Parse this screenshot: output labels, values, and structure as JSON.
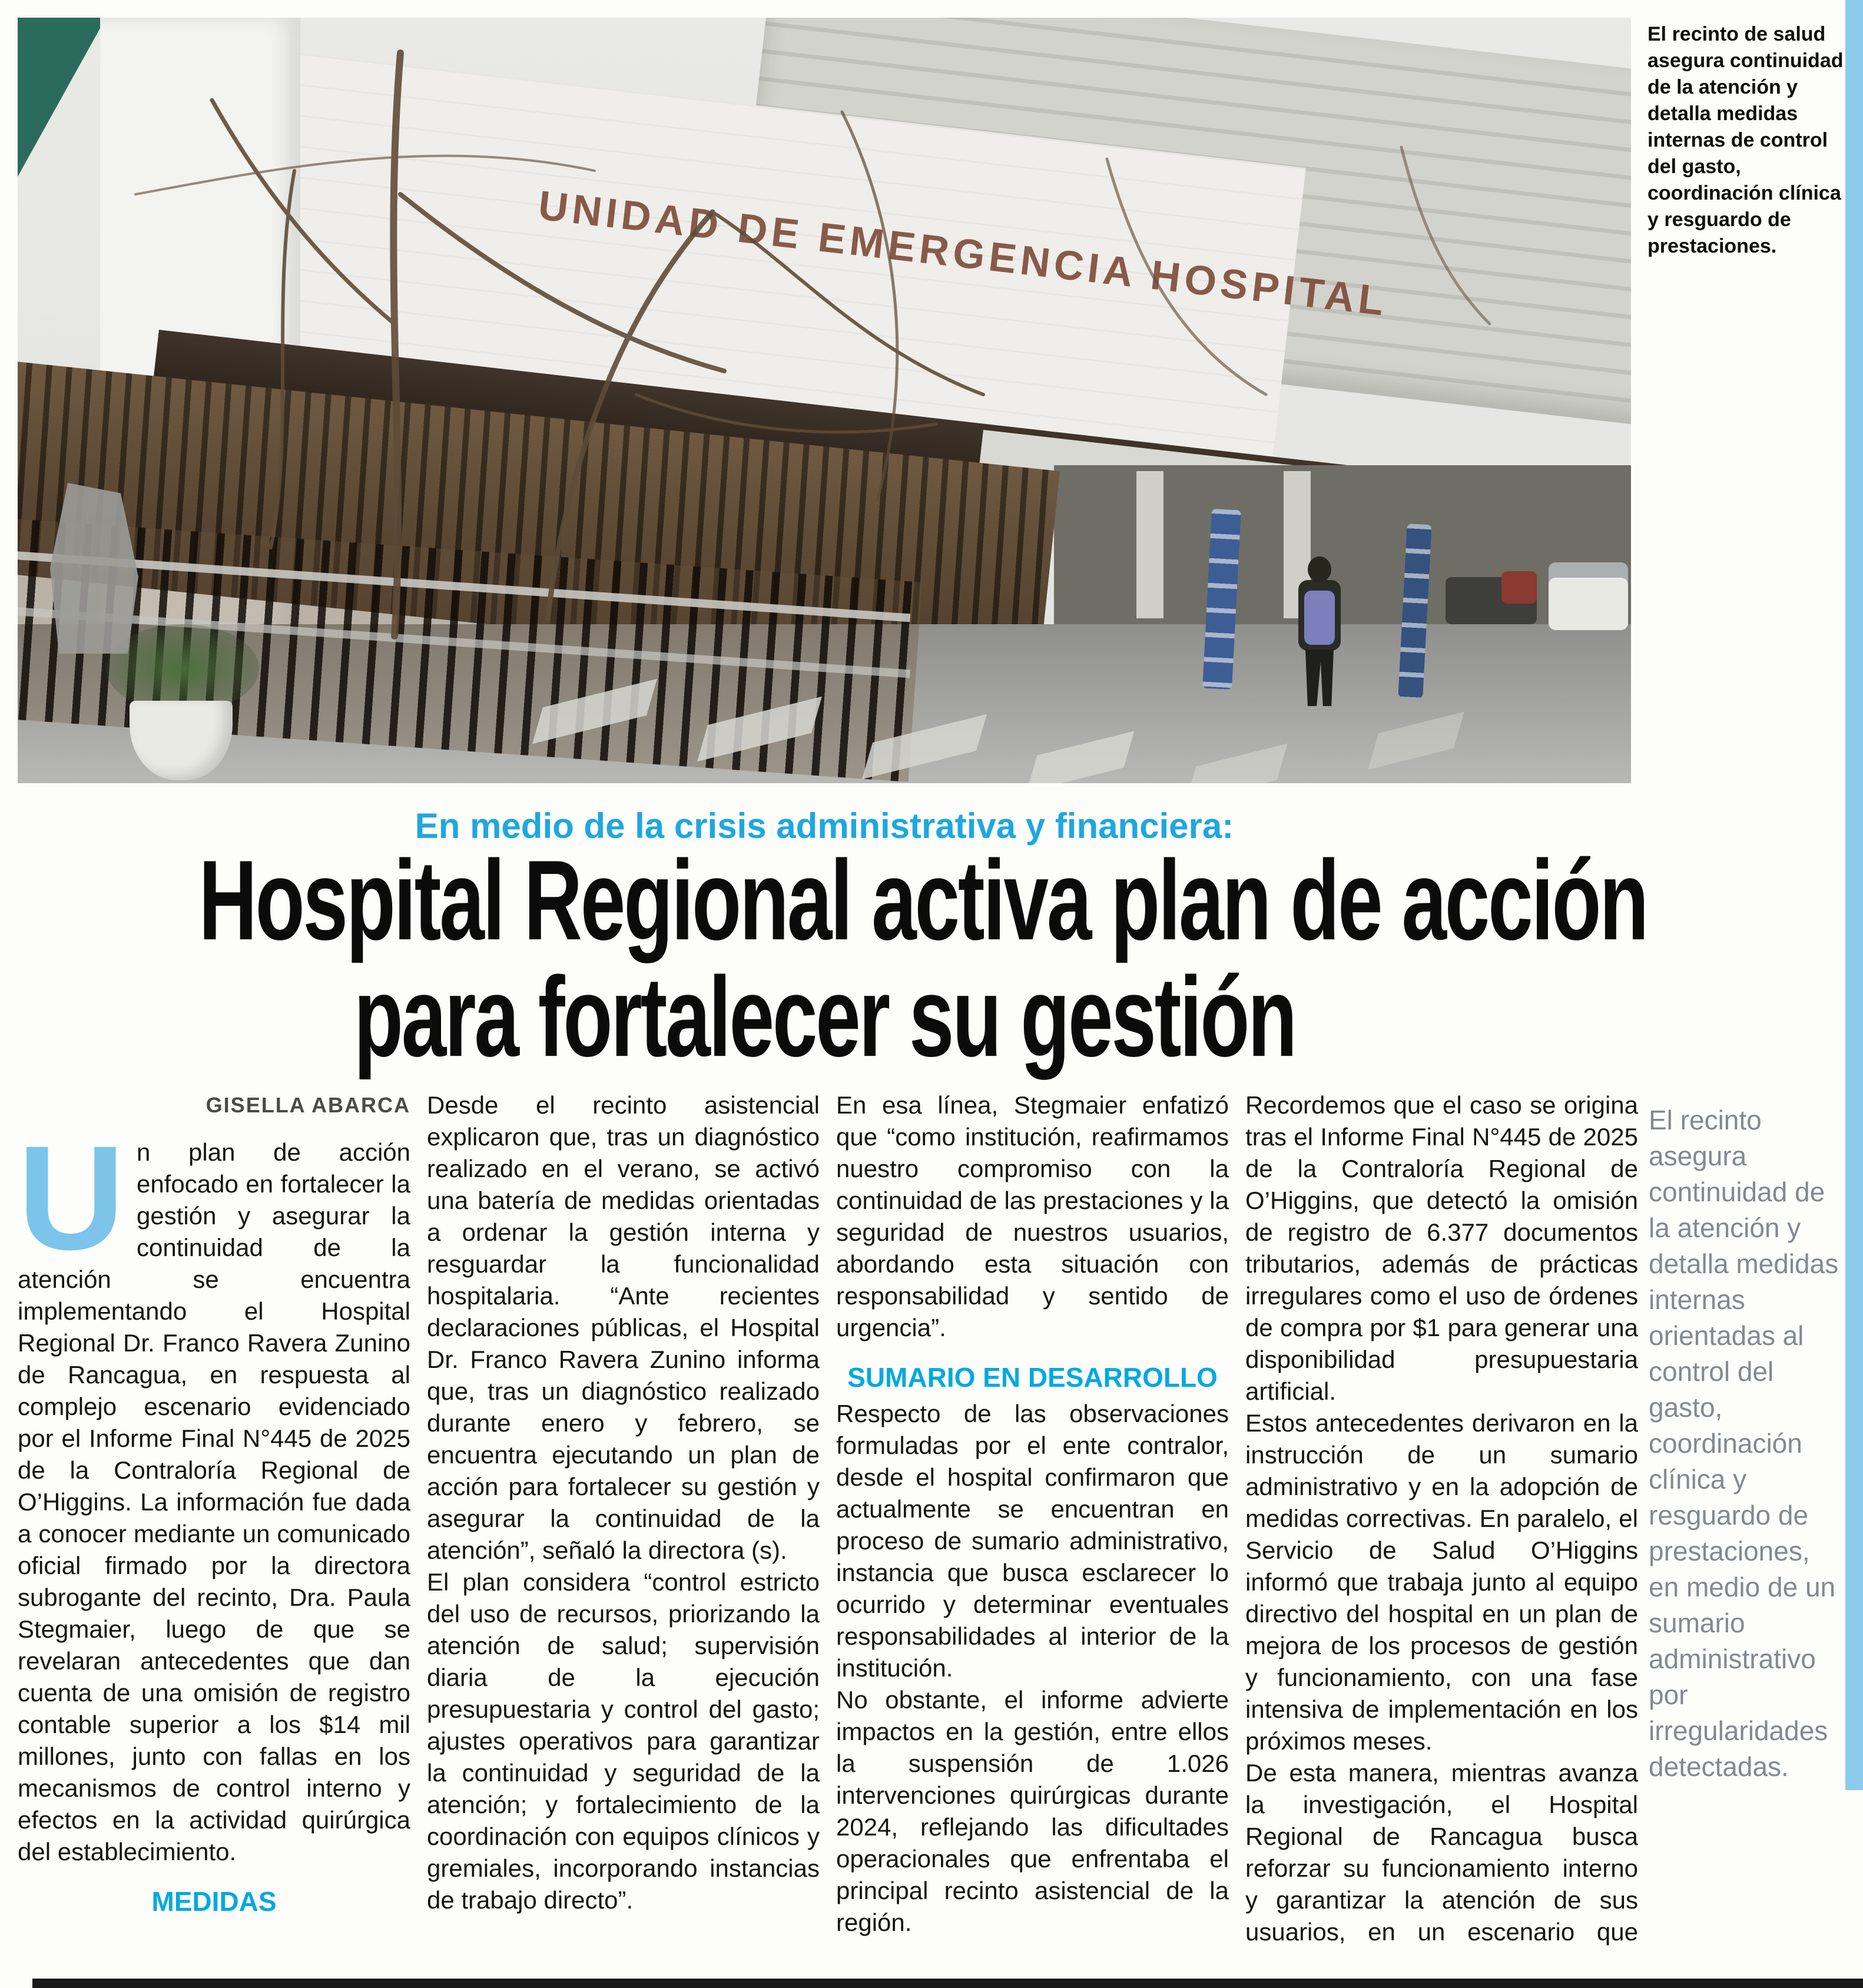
{
  "photo": {
    "sign_text": "UNIDAD DE EMERGENCIA HOSPITAL",
    "caption": "El recinto de salud asegura continuidad de la atención y detalla medidas internas de control del gasto, coordinación clínica y resguardo de prestaciones."
  },
  "kicker": "En medio de la crisis administrativa y financiera:",
  "headline": {
    "line1": "Hospital Regional activa plan de acción",
    "line2": "para fortalecer su gestión"
  },
  "byline": "GISELLA ABARCA",
  "article": {
    "blocks": [
      {
        "type": "p",
        "dropcap": true,
        "text": "Un plan de acción enfocado en fortalecer la gestión y asegurar la continuidad de la atención se encuentra implementando el Hospital Regional Dr. Franco Ravera Zunino de Rancagua, en respuesta al complejo escenario evidenciado por el Informe Final N°445 de 2025 de la Contraloría Regional de O’Higgins. La información fue dada a conocer mediante un comunicado oficial firmado por la directora subrogante del recinto, Dra. Paula Stegmaier, luego de que se revelaran antecedentes que dan cuenta de una omisión de registro contable superior a los $14 mil millones, junto con fallas en los mecanismos de control interno y efectos en la actividad quirúrgica del establecimiento."
      },
      {
        "type": "subhead",
        "text": "MEDIDAS"
      },
      {
        "type": "p",
        "text": "Desde el recinto asistencial explicaron que, tras un diagnóstico realizado en el verano, se activó una batería de medidas orientadas a ordenar la gestión interna y resguardar la funcionalidad hospitalaria. “Ante recientes declaraciones públicas, el Hospital Dr. Franco Ravera Zunino informa que, tras un diagnóstico realizado durante enero y febrero, se encuentra ejecutando un plan de acción para fortalecer su gestión y asegurar la continuidad de la atención”, señaló la directora (s)."
      },
      {
        "type": "p",
        "text": "El plan considera “control estricto del uso de recursos, priorizando la atención de salud; supervisión diaria de la ejecución presupuestaria y control del gasto; ajustes operativos para garantizar la continuidad y seguridad de la atención; y fortalecimiento de la coordinación con equipos clínicos y gremiales, incorporando instancias de trabajo directo”."
      },
      {
        "type": "p",
        "text": "En esa línea, Stegmaier enfatizó que “como institución, reafirmamos nuestro compromiso con la continuidad de las prestaciones y la seguridad de nuestros usuarios, abordando esta situación con responsabilidad y sentido de urgencia”."
      },
      {
        "type": "subhead",
        "text": "SUMARIO EN DESARROLLO"
      },
      {
        "type": "p",
        "text": "Respecto de las observaciones formuladas por el ente contralor, desde el hospital confirmaron que actualmente se encuentran en proceso de sumario administrativo, instancia que busca esclarecer lo ocurrido y determinar eventuales responsabilidades al interior de la institución."
      },
      {
        "type": "p",
        "text": "No obstante, el informe advierte impactos en la gestión, entre ellos la suspensión de 1.026 intervenciones quirúrgicas durante 2024, reflejando las dificultades operacionales que enfrentaba el principal recinto asistencial de la región."
      },
      {
        "type": "p",
        "text": "Recordemos que el caso se origina tras el Informe Final N°445 de 2025 de la Contraloría Regional de O’Higgins, que detectó la omisión de registro de 6.377 documentos tributarios, además de prácticas irregulares como el uso de órdenes de compra por $1 para generar una disponibilidad presupuestaria artificial."
      },
      {
        "type": "p",
        "text": "Estos antecedentes derivaron en la instrucción de un sumario administrativo y en la adopción de medidas correctivas. En paralelo, el Servicio de Salud O’Higgins informó que trabaja junto al equipo directivo del hospital en un plan de mejora de los procesos de gestión y funcionamiento, con una fase intensiva de implementación en los próximos meses."
      },
      {
        "type": "p",
        "text": "De esta manera, mientras avanza la investigación, el Hospital Regional de Rancagua busca reforzar su funcionamiento interno y garantizar la atención de sus usuarios, en un escenario que sigue bajo revisión y con exigencias de mayor claridad en su gestión financiera."
      }
    ]
  },
  "pull_quote": "El recinto asegura continuidad de la atención y detalla medidas internas orientadas al control del gasto, coordinación clínica y resguardo de prestaciones, en medio de un sumario administrativo por irregularidades detectadas.",
  "colors": {
    "kicker_blue": "#1fa7e0",
    "subhead_blue": "#00a9e0",
    "dropcap_blue": "#7cc4ea",
    "pullquote_gray": "#84898f",
    "edge_bar_blue": "#8ccbec"
  }
}
